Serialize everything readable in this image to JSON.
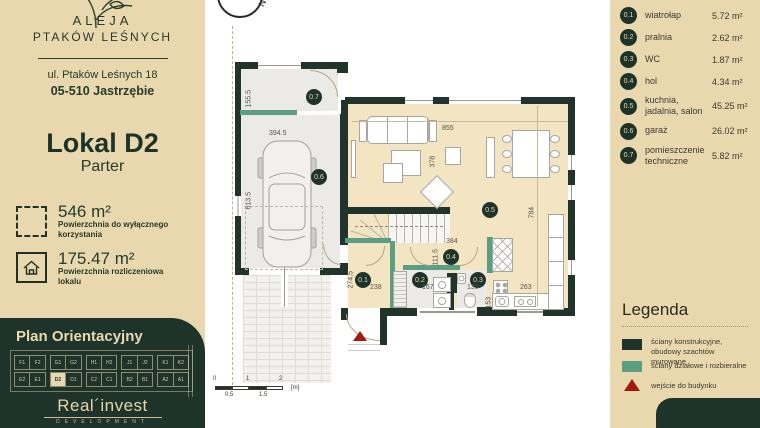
{
  "sidebar": {
    "brand_line1": "ALEJA",
    "brand_line2": "PTAKÓW LEŚNYCH",
    "address_line1": "ul. Ptaków Leśnych 18",
    "address_line2": "05-510 Jastrzębie",
    "unit_title": "Lokal D2",
    "unit_floor": "Parter",
    "area1_value": "546 m²",
    "area1_label": "Powierzchnia do wyłącznego korzystania",
    "area2_value": "175.47 m²",
    "area2_label": "Powierzchnia rozliczeniowa lokalu",
    "orientation_title": "Plan Orientacyjny",
    "site_units_top": [
      {
        "a": "F1",
        "b": "F2"
      },
      {
        "a": "G1",
        "b": "G2"
      },
      {
        "a": "H1",
        "b": "H2"
      },
      {
        "a": "J1",
        "b": "J2"
      },
      {
        "a": "K1",
        "b": "K2"
      }
    ],
    "site_units_bottom": [
      {
        "a": "E2",
        "b": "E1"
      },
      {
        "a": "D2",
        "b": "D1",
        "hl": "a"
      },
      {
        "a": "C2",
        "b": "C1"
      },
      {
        "a": "B2",
        "b": "B1"
      },
      {
        "a": "A2",
        "b": "A1"
      }
    ],
    "developer_name": "Real",
    "developer_name2": "invest",
    "developer_sub": "DEVELOPMENT"
  },
  "rooms": [
    {
      "no": "0.1",
      "name": "wiatrołap",
      "area": "5.72 m²"
    },
    {
      "no": "0.2",
      "name": "pralnia",
      "area": "2.62 m²"
    },
    {
      "no": "0.3",
      "name": "WC",
      "area": "1.87 m²"
    },
    {
      "no": "0.4",
      "name": "hol",
      "area": "4.34 m²"
    },
    {
      "no": "0.5",
      "name": "kuchnia, jadalnia, salon",
      "area": "45.25 m²"
    },
    {
      "no": "0.6",
      "name": "garaż",
      "area": "26.02 m²"
    },
    {
      "no": "0.7",
      "name": "pomieszczenie techniczne",
      "area": "5.82 m²"
    }
  ],
  "legend": {
    "title": "Legenda",
    "items": [
      {
        "label": "ściany konstrukcyjne, obudowy szachtów murowane",
        "type": "wall-solid"
      },
      {
        "label": "ściany działowe i rozbieralne",
        "type": "wall-partition"
      },
      {
        "label": "wejście do budynku",
        "type": "entrance"
      }
    ]
  },
  "plan": {
    "compass": "N",
    "dims": {
      "d1555": "155.5",
      "d3945": "394.5",
      "d6135": "613.5",
      "d855": "855",
      "d378": "378",
      "d784": "784",
      "d384": "384",
      "d1115": "111.5",
      "d238": "238",
      "d2745": "274.5",
      "d167": "167",
      "d130": "130",
      "d153": "153",
      "d263": "263"
    },
    "scale": {
      "t0": "0",
      "t05": "0.5",
      "t1": "1",
      "t15": "1.5",
      "t2": "2",
      "unit": "[m]"
    }
  },
  "colors": {
    "beige": "#e9d8ad",
    "dark_green": "#1e332a",
    "partition_teal": "#5b9e81",
    "entrance_red": "#9f1b0f",
    "floor_beige": "#f3e5c2",
    "floor_gray": "#ebeae6"
  }
}
